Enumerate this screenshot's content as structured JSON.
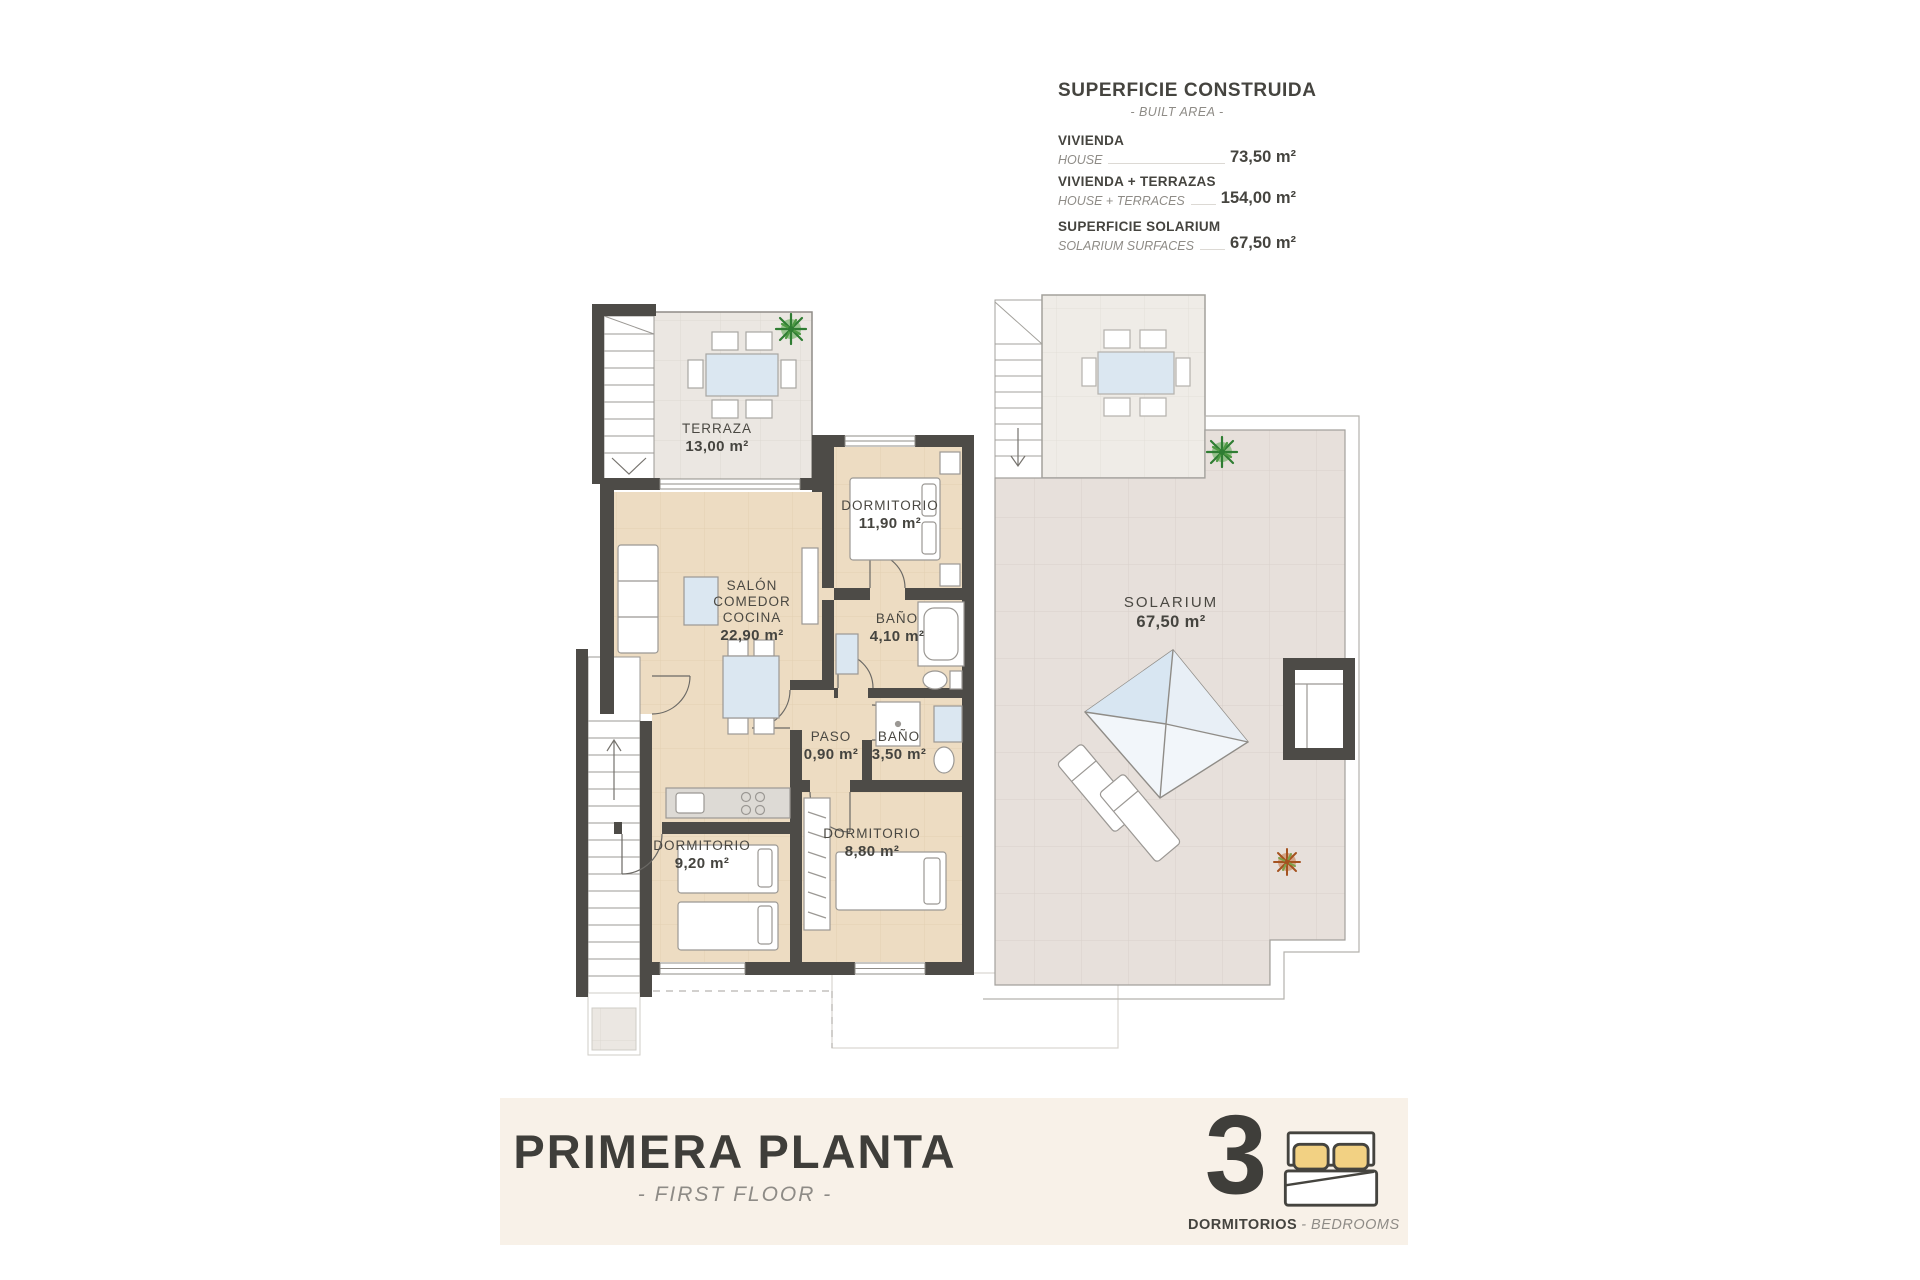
{
  "area_table": {
    "title": "SUPERFICIE CONSTRUIDA",
    "subtitle": "- BUILT AREA -",
    "rows": [
      {
        "label": "VIVIENDA",
        "sublabel": "HOUSE",
        "value": "73,50 m²"
      },
      {
        "label": "VIVIENDA + TERRAZAS",
        "sublabel": "HOUSE + TERRACES",
        "value": "154,00 m²"
      },
      {
        "label": "SUPERFICIE SOLARIUM",
        "sublabel": "SOLARIUM SURFACES",
        "value": "67,50 m²"
      }
    ]
  },
  "rooms": {
    "terraza": {
      "name": "TERRAZA",
      "area": "13,00 m²"
    },
    "dormitorio1": {
      "name": "DORMITORIO",
      "area": "11,90 m²"
    },
    "salon": {
      "name": "SALÓN COMEDOR COCINA",
      "area": "22,90 m²"
    },
    "bano1": {
      "name": "BAÑO",
      "area": "4,10 m²"
    },
    "paso": {
      "name": "PASO",
      "area": "0,90 m²"
    },
    "bano2": {
      "name": "BAÑO",
      "area": "3,50 m²"
    },
    "dormitorio2": {
      "name": "DORMITORIO",
      "area": "9,20 m²"
    },
    "dormitorio3": {
      "name": "DORMITORIO",
      "area": "8,80 m²"
    },
    "solarium": {
      "name": "SOLARIUM",
      "area": "67,50 m²"
    }
  },
  "footer": {
    "title": "PRIMERA PLANTA",
    "subtitle": "- FIRST FLOOR -",
    "bedrooms_count": "3",
    "bedrooms_label": "DORMITORIOS",
    "bedrooms_sublabel": "- BEDROOMS",
    "bedrooms_icon": "bed-icon"
  },
  "colors": {
    "wall": "#4d4b47",
    "floor_beige": "#eddcc2",
    "tile_terrace": "#ebe7e2",
    "tile_solarium": "#e7e0db",
    "tile_upper": "#efece7",
    "band_cream": "#f8f1e8",
    "text_dark": "#45443f",
    "text_gray": "#8e8b86",
    "glass_blue": "#dbe7f1",
    "pillow_yellow": "#f2d183",
    "plant_green": "#58a84d",
    "plant_orange": "#c06a35",
    "line_gray": "#9b9894"
  }
}
